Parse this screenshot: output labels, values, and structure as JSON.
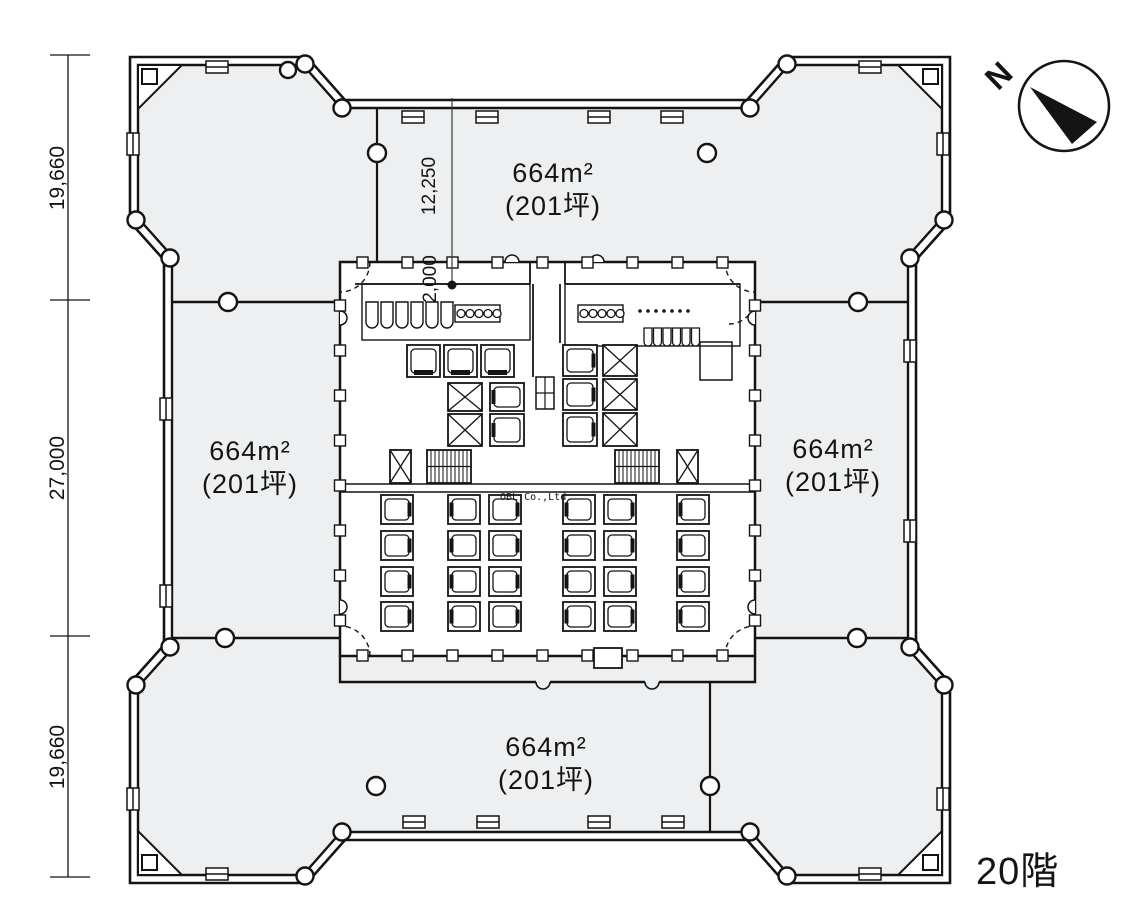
{
  "plan": {
    "floor_label": "20階",
    "compass": {
      "north_label": "N"
    },
    "watermark": "OBL Co.,Ltd.",
    "dimensions": {
      "left_top": "19,660",
      "left_middle": "27,000",
      "left_bottom": "19,660",
      "top_offset": "12,250",
      "core_offset": "2,000"
    },
    "areas": [
      {
        "id": "north",
        "size_m2": "664m²",
        "size_tsubo": "(201坪)"
      },
      {
        "id": "west",
        "size_m2": "664m²",
        "size_tsubo": "(201坪)"
      },
      {
        "id": "east",
        "size_m2": "664m²",
        "size_tsubo": "(201坪)"
      },
      {
        "id": "south",
        "size_m2": "664m²",
        "size_tsubo": "(201坪)"
      }
    ],
    "colors": {
      "floor_fill": "#edeff0",
      "line": "#141414",
      "background": "#ffffff"
    }
  }
}
